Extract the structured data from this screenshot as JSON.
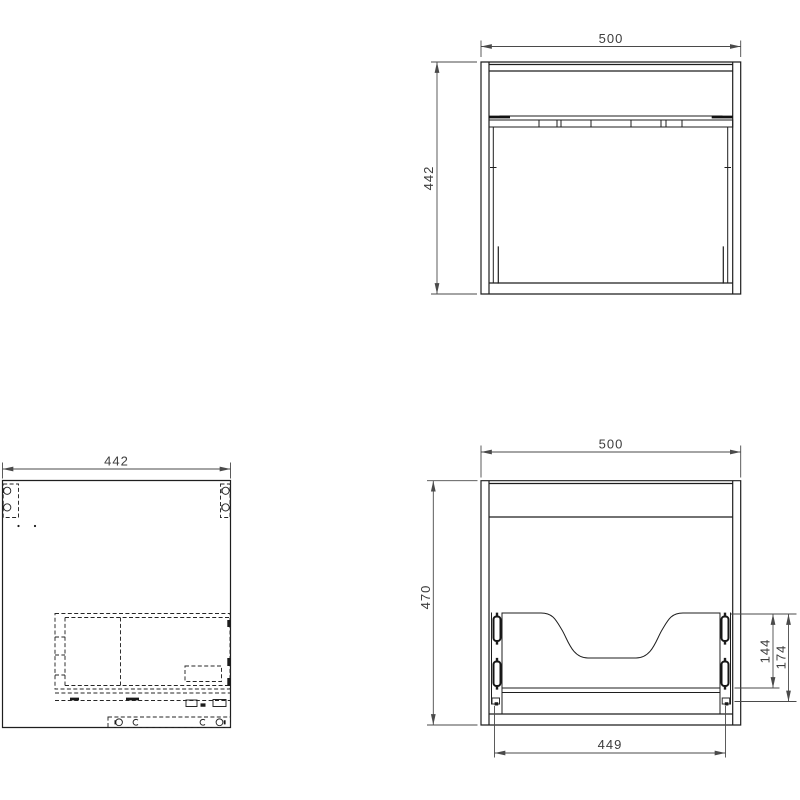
{
  "drawing": {
    "background": "#ffffff",
    "colors": {
      "object_line": "#1e1e1e",
      "hidden_line": "#262626",
      "dimension_line": "#4a4a4a",
      "label_text": "#3d3d3d"
    },
    "views": {
      "rear": {
        "width": "500",
        "height": "442"
      },
      "side": {
        "depth": "442"
      },
      "front": {
        "width": "500",
        "height": "470",
        "recess_height": "144",
        "drawer_field_height": "174",
        "runner_length": "449"
      }
    }
  }
}
